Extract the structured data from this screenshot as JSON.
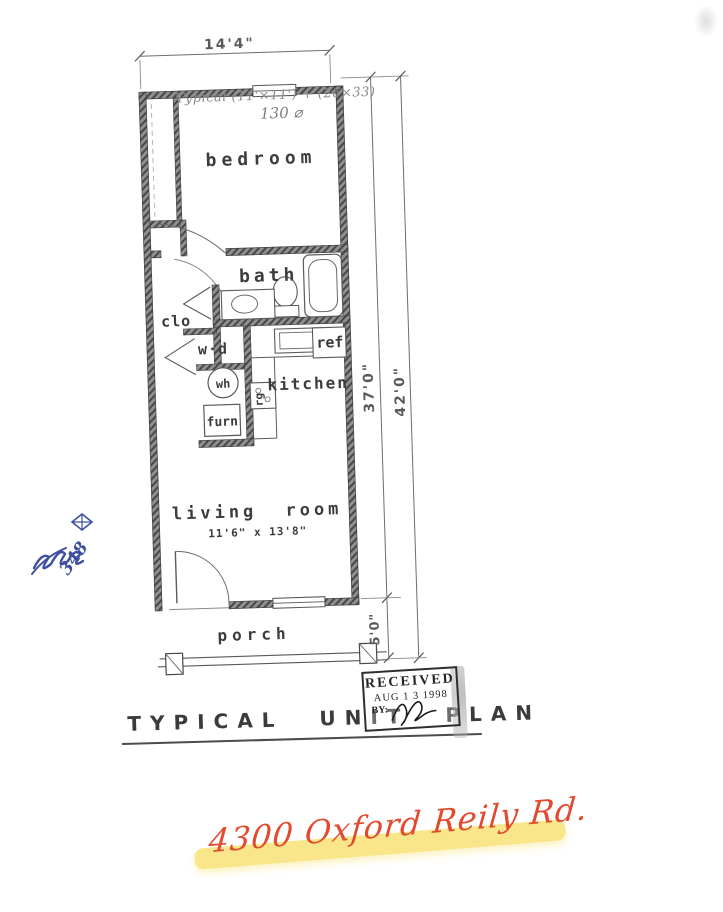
{
  "document": {
    "title": "TYPICAL UNIT PLAN",
    "background": "#ffffff"
  },
  "plan": {
    "rooms": {
      "bedroom": "bedroom",
      "bath": "bath",
      "closet": "clo",
      "washer_dryer": "w·d",
      "water_heater": "wh",
      "furnace": "furn",
      "refrigerator": "ref",
      "range": "rg",
      "kitchen": "kitchen",
      "living_room": "living room",
      "living_room_size": "11'6\" x 13'8\"",
      "porch": "porch"
    },
    "dimensions": {
      "width": "14'4\"",
      "unit_depth": "37'0\"",
      "total_depth": "42'0\"",
      "porch_depth": "5'0\""
    }
  },
  "stamp": {
    "received": "RECEIVED",
    "date": "AUG 1 3 1998",
    "by": "BY:"
  },
  "annotations": {
    "pencil_note": "Typical (11'×11') + (26×33)",
    "pencil_area": "130 ⌀",
    "blue_number": "348",
    "address": "4300 Oxford Reily Rd."
  },
  "colors": {
    "ink": "#3f3f3f",
    "wall": "#8f8f8f",
    "pencil": "#8a8a8a",
    "blue_ink": "#3e4fa3",
    "red_ink": "#e2492e",
    "highlight": "#f8e16e"
  }
}
